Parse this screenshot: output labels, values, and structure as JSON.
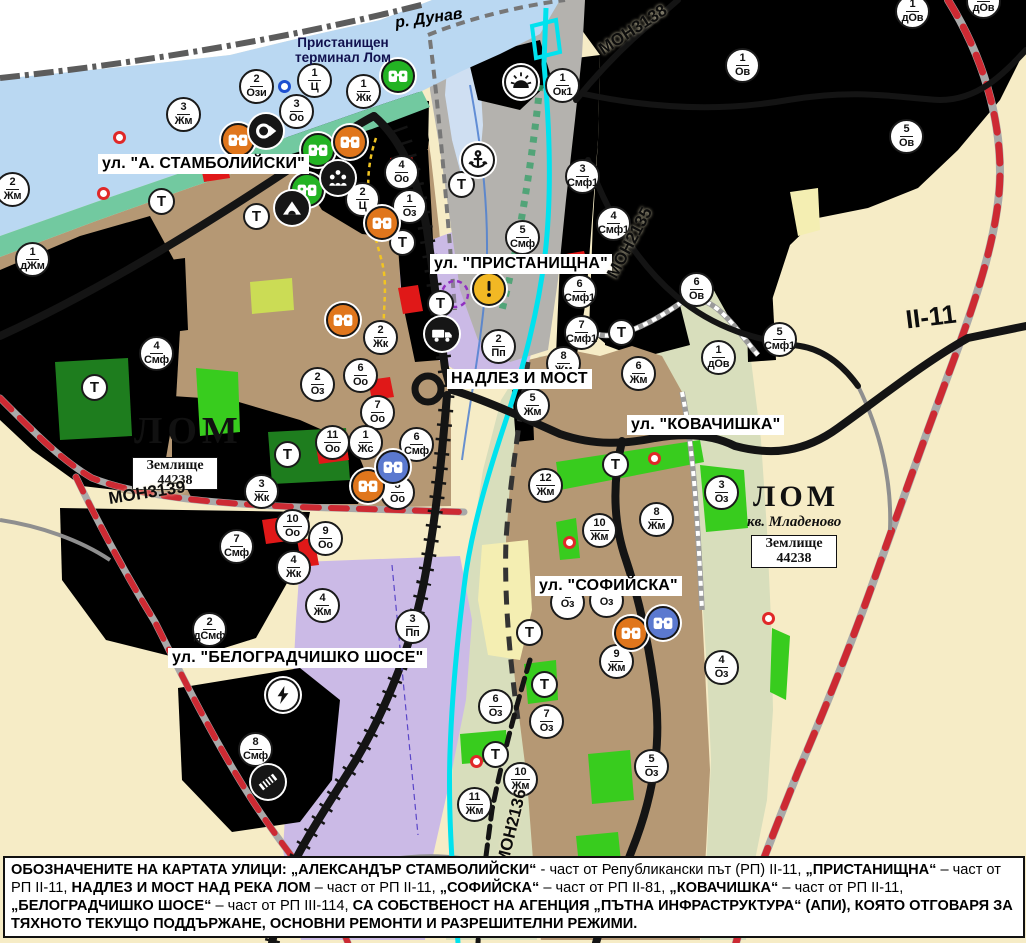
{
  "colors": {
    "water": "#bad8f2",
    "water_light": "#cfdff2",
    "coast": "#72c9a0",
    "town": "#b59874",
    "town_line": "#8f7b55",
    "cream": "#f6ecc6",
    "cream_line": "#c8b280",
    "lav": "#cbbae6",
    "lav_line": "#a08fd0",
    "pgreen": "#d8debc",
    "pgreen_line": "#9fae7f",
    "vine_bg": "#dbd867",
    "vine_bar": "#5ea82a",
    "vine_line": "#9a9a4a",
    "yb_bg": "#f7e47a",
    "yb_bar": "#a67e1d",
    "yb_line": "#c8a94a",
    "dy_bg": "#e0be4e",
    "dy_bar": "#8a6410",
    "red_bg": "#f6d6e2",
    "red_bar": "#cb2446",
    "pink_bg": "#f2b6ca",
    "pink_bar": "#d43058",
    "city_bg": "#f4bdbd",
    "city_line": "#d19292",
    "or_bg": "#e8873a",
    "or_line": "#8a4712",
    "green_bright": "#38cc1e",
    "green_dark": "#1e7d1e",
    "yellgreen": "#cbdc55",
    "paleyellow": "#f4eeb2",
    "red_patch": "#e01818",
    "road": "#141414",
    "gray_road": "#8f8f8f",
    "red_dash": "#cd2a33",
    "cyan": "#00e2ee",
    "border": "#5c5c5c",
    "blue_line": "#4d7fd0",
    "navy": "#10104e",
    "river_blue": "#2a52be"
  },
  "water_label": {
    "text": "р. Дунав"
  },
  "port_label": {
    "line1": "Пристанищен",
    "line2": "терминал Лом"
  },
  "city_labels": [
    {
      "text": "ЛОМ"
    },
    {
      "text": "ЛОМ"
    }
  ],
  "district_label": {
    "text": "кв. Младеново"
  },
  "plot_boxes": [
    {
      "line1": "Землище",
      "line2": "44238"
    },
    {
      "line1": "Землище",
      "line2": "44238"
    }
  ],
  "street_labels": [
    {
      "text": "ул. \"А. СТАМБОЛИЙСКИ\"",
      "x": 98,
      "y": 154
    },
    {
      "text": "ул. \"ПРИСТАНИЩНА\"",
      "x": 430,
      "y": 254
    },
    {
      "text": "НАДЛЕЗ И МОСТ",
      "x": 447,
      "y": 369
    },
    {
      "text": "ул. \"КОВАЧИШКА\"",
      "x": 627,
      "y": 415
    },
    {
      "text": "ул. \"СОФИЙСКА\"",
      "x": 535,
      "y": 576
    },
    {
      "text": "ул. \"БЕЛОГРАДЧИШКО ШОСЕ\"",
      "x": 168,
      "y": 648
    }
  ],
  "road_labels": [
    {
      "text": "МОН3138",
      "x": 633,
      "y": 30,
      "rot": -33,
      "size": 17
    },
    {
      "text": "МОН2135",
      "x": 630,
      "y": 243,
      "rot": -62,
      "size": 17
    },
    {
      "text": "МОН3139",
      "x": 147,
      "y": 493,
      "rot": -9,
      "size": 17
    },
    {
      "text": "МОН2136",
      "x": 512,
      "y": 827,
      "rot": -76,
      "size": 17
    },
    {
      "text": "II-11",
      "x": 931,
      "y": 317,
      "rot": -7,
      "size": 26
    }
  ],
  "t_symbol": "Т",
  "t_markers": [
    {
      "x": 162,
      "y": 202
    },
    {
      "x": 257,
      "y": 217
    },
    {
      "x": 462,
      "y": 185
    },
    {
      "x": 403,
      "y": 243
    },
    {
      "x": 441,
      "y": 304
    },
    {
      "x": 95,
      "y": 388
    },
    {
      "x": 288,
      "y": 455
    },
    {
      "x": 622,
      "y": 333
    },
    {
      "x": 616,
      "y": 465
    },
    {
      "x": 530,
      "y": 633
    },
    {
      "x": 545,
      "y": 685
    },
    {
      "x": 496,
      "y": 755
    }
  ],
  "zone_markers": [
    {
      "x": 257,
      "y": 87,
      "num": "2",
      "code": "Ози"
    },
    {
      "x": 315,
      "y": 81,
      "num": "1",
      "code": "Ц"
    },
    {
      "x": 364,
      "y": 92,
      "num": "1",
      "code": "Жк"
    },
    {
      "x": 297,
      "y": 112,
      "num": "3",
      "code": "Оо"
    },
    {
      "x": 563,
      "y": 86,
      "num": "1",
      "code": "Ок1"
    },
    {
      "x": 184,
      "y": 115,
      "num": "3",
      "code": "Жм"
    },
    {
      "x": 13,
      "y": 190,
      "num": "2",
      "code": "Жм"
    },
    {
      "x": 33,
      "y": 260,
      "num": "1",
      "code": "дЖм"
    },
    {
      "x": 402,
      "y": 173,
      "num": "4",
      "code": "Оо"
    },
    {
      "x": 363,
      "y": 200,
      "num": "2",
      "code": "Ц"
    },
    {
      "x": 410,
      "y": 207,
      "num": "1",
      "code": "Оз"
    },
    {
      "x": 913,
      "y": 12,
      "num": "1",
      "code": "дОв"
    },
    {
      "x": 984,
      "y": 2,
      "num": "1",
      "code": "дОв"
    },
    {
      "x": 743,
      "y": 66,
      "num": "1",
      "code": "Ов"
    },
    {
      "x": 907,
      "y": 137,
      "num": "5",
      "code": "Ов"
    },
    {
      "x": 583,
      "y": 177,
      "num": "3",
      "code": "Смф1"
    },
    {
      "x": 614,
      "y": 224,
      "num": "4",
      "code": "Смф1"
    },
    {
      "x": 523,
      "y": 238,
      "num": "5",
      "code": "Смф"
    },
    {
      "x": 580,
      "y": 292,
      "num": "6",
      "code": "Смф1"
    },
    {
      "x": 582,
      "y": 333,
      "num": "7",
      "code": "Смф1"
    },
    {
      "x": 697,
      "y": 290,
      "num": "6",
      "code": "Ов"
    },
    {
      "x": 780,
      "y": 340,
      "num": "5",
      "code": "Смф1"
    },
    {
      "x": 719,
      "y": 358,
      "num": "1",
      "code": "дОв"
    },
    {
      "x": 499,
      "y": 347,
      "num": "2",
      "code": "Пп"
    },
    {
      "x": 564,
      "y": 364,
      "num": "8",
      "code": "Жм"
    },
    {
      "x": 639,
      "y": 374,
      "num": "6",
      "code": "Жм"
    },
    {
      "x": 533,
      "y": 406,
      "num": "5",
      "code": "Жм"
    },
    {
      "x": 381,
      "y": 338,
      "num": "2",
      "code": "Жк"
    },
    {
      "x": 361,
      "y": 376,
      "num": "6",
      "code": "Оо"
    },
    {
      "x": 318,
      "y": 385,
      "num": "2",
      "code": "Оз"
    },
    {
      "x": 378,
      "y": 413,
      "num": "7",
      "code": "Оо"
    },
    {
      "x": 333,
      "y": 443,
      "num": "11",
      "code": "Оо"
    },
    {
      "x": 366,
      "y": 443,
      "num": "1",
      "code": "Жс"
    },
    {
      "x": 417,
      "y": 445,
      "num": "6",
      "code": "Смф"
    },
    {
      "x": 398,
      "y": 493,
      "num": "8",
      "code": "Оо"
    },
    {
      "x": 262,
      "y": 492,
      "num": "3",
      "code": "Жк"
    },
    {
      "x": 293,
      "y": 527,
      "num": "10",
      "code": "Оо"
    },
    {
      "x": 326,
      "y": 539,
      "num": "9",
      "code": "Оо"
    },
    {
      "x": 237,
      "y": 547,
      "num": "7",
      "code": "Смф"
    },
    {
      "x": 294,
      "y": 568,
      "num": "4",
      "code": "Жк"
    },
    {
      "x": 323,
      "y": 606,
      "num": "4",
      "code": "Жм"
    },
    {
      "x": 210,
      "y": 630,
      "num": "2",
      "code": "дСмф"
    },
    {
      "x": 413,
      "y": 627,
      "num": "3",
      "code": "Пп"
    },
    {
      "x": 157,
      "y": 354,
      "num": "4",
      "code": "Смф"
    },
    {
      "x": 256,
      "y": 750,
      "num": "8",
      "code": "Смф"
    },
    {
      "x": 546,
      "y": 486,
      "num": "12",
      "code": "Жм"
    },
    {
      "x": 600,
      "y": 531,
      "num": "10",
      "code": "Жм"
    },
    {
      "x": 657,
      "y": 520,
      "num": "8",
      "code": "Жм"
    },
    {
      "x": 722,
      "y": 493,
      "num": "3",
      "code": "Оз"
    },
    {
      "x": 568,
      "y": 603,
      "num": "",
      "code": "Оз"
    },
    {
      "x": 607,
      "y": 601,
      "num": "",
      "code": "Оз"
    },
    {
      "x": 617,
      "y": 662,
      "num": "9",
      "code": "Жм"
    },
    {
      "x": 496,
      "y": 707,
      "num": "6",
      "code": "Оз"
    },
    {
      "x": 547,
      "y": 722,
      "num": "7",
      "code": "Оз"
    },
    {
      "x": 652,
      "y": 767,
      "num": "5",
      "code": "Оз"
    },
    {
      "x": 722,
      "y": 668,
      "num": "4",
      "code": "Оз"
    },
    {
      "x": 521,
      "y": 780,
      "num": "10",
      "code": "Жм"
    },
    {
      "x": 475,
      "y": 805,
      "num": "11",
      "code": "Жм"
    }
  ],
  "icon_markers": [
    {
      "x": 398,
      "y": 76,
      "icon": "culture-monument-green"
    },
    {
      "x": 318,
      "y": 150,
      "icon": "culture-monument-green"
    },
    {
      "x": 307,
      "y": 190,
      "icon": "culture-monument-green"
    },
    {
      "x": 238,
      "y": 140,
      "icon": "culture-monument-orange"
    },
    {
      "x": 350,
      "y": 142,
      "icon": "culture-monument-orange"
    },
    {
      "x": 382,
      "y": 223,
      "icon": "culture-monument-orange"
    },
    {
      "x": 343,
      "y": 320,
      "icon": "culture-monument-orange"
    },
    {
      "x": 368,
      "y": 486,
      "icon": "culture-monument-orange"
    },
    {
      "x": 631,
      "y": 633,
      "icon": "culture-monument-orange"
    },
    {
      "x": 393,
      "y": 467,
      "icon": "culture-monument-blue"
    },
    {
      "x": 663,
      "y": 623,
      "icon": "culture-monument-blue"
    },
    {
      "x": 266,
      "y": 131,
      "icon": "ring-arrow-monument"
    },
    {
      "x": 338,
      "y": 178,
      "icon": "group-monument"
    },
    {
      "x": 292,
      "y": 208,
      "icon": "cave-monument"
    },
    {
      "x": 442,
      "y": 334,
      "icon": "freight-terminal"
    },
    {
      "x": 478,
      "y": 160,
      "icon": "port-anchor"
    },
    {
      "x": 521,
      "y": 82,
      "icon": "sunrise-symbol"
    },
    {
      "x": 489,
      "y": 289,
      "icon": "warning-sign"
    },
    {
      "x": 283,
      "y": 695,
      "icon": "power-substation"
    },
    {
      "x": 268,
      "y": 782,
      "icon": "railway-crossing"
    }
  ],
  "dot_markers": {
    "red": [
      [
        120,
        138
      ],
      [
        104,
        194
      ],
      [
        655,
        459
      ],
      [
        570,
        543
      ],
      [
        769,
        619
      ],
      [
        477,
        762
      ]
    ],
    "blue": [
      [
        285,
        87
      ]
    ]
  },
  "footer": {
    "segments": [
      {
        "t": "ОБОЗНАЧЕНИТЕ НА КАРТАТА УЛИЦИ: „АЛЕКСАНДЪР СТАМБОЛИЙСКИ“",
        "b": true
      },
      {
        "t": " - част от Републикански път (РП) II-11, ",
        "b": false
      },
      {
        "t": "„ПРИСТАНИЩНА“",
        "b": true
      },
      {
        "t": " – част от РП II-11, ",
        "b": false
      },
      {
        "t": "НАДЛЕЗ И МОСТ НАД РЕКА ЛОМ",
        "b": true
      },
      {
        "t": " – част от РП II-11, ",
        "b": false
      },
      {
        "t": "„СОФИЙСКА“",
        "b": true
      },
      {
        "t": " – част от РП II-81, ",
        "b": false
      },
      {
        "t": "„КОВАЧИШКА“",
        "b": true
      },
      {
        "t": " – част от РП II-11, ",
        "b": false
      },
      {
        "t": "„БЕЛОГРАДЧИШКО ШОСЕ“",
        "b": true
      },
      {
        "t": " – част от РП III-114, ",
        "b": false
      },
      {
        "t": "СА СОБСТВЕНОСТ НА АГЕНЦИЯ „ПЪТНА ИНФРАСТРУКТУРА“ (АПИ), КОЯТО ОТГОВАРЯ ЗА ТЯХНОТО ТЕКУЩО ПОДДЪРЖАНЕ, ОСНОВНИ РЕМОНТИ И РАЗРЕШИТЕЛНИ РЕЖИМИ.",
        "b": true
      }
    ]
  }
}
